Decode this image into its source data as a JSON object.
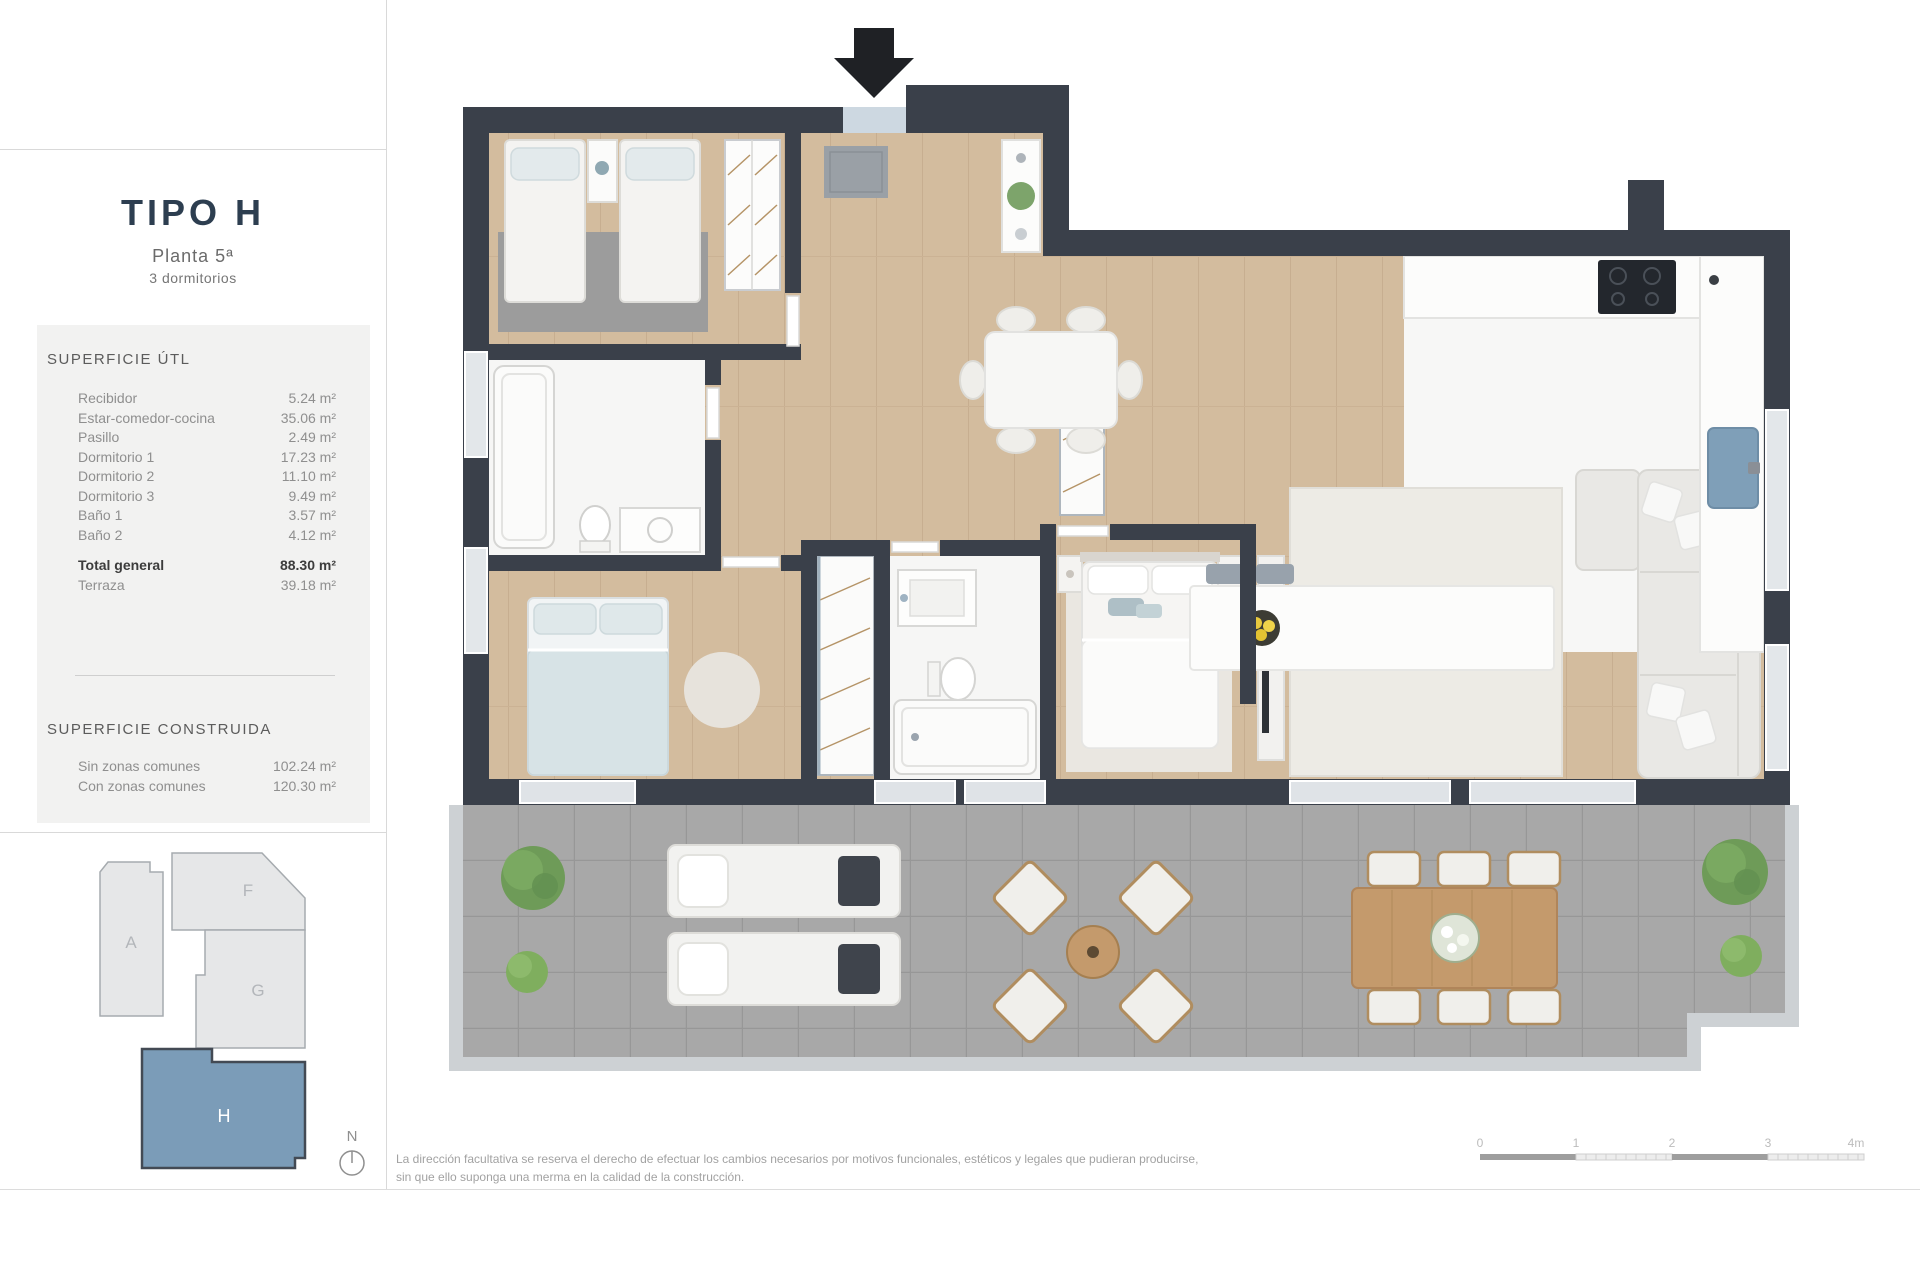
{
  "sidebar": {
    "title": "TIPO H",
    "subtitle": "Planta 5ª",
    "subtitle2": "3 dormitorios",
    "superficie_util": {
      "heading": "SUPERFICIE ÚTL",
      "rows": [
        {
          "label": "Recibidor",
          "value": "5.24 m²"
        },
        {
          "label": "Estar-comedor-cocina",
          "value": "35.06 m²"
        },
        {
          "label": "Pasillo",
          "value": "2.49 m²"
        },
        {
          "label": "Dormitorio 1",
          "value": "17.23 m²"
        },
        {
          "label": "Dormitorio 2",
          "value": "11.10 m²"
        },
        {
          "label": "Dormitorio 3",
          "value": "9.49 m²"
        },
        {
          "label": "Baño 1",
          "value": "3.57 m²"
        },
        {
          "label": "Baño 2",
          "value": "4.12 m²"
        }
      ],
      "total": {
        "label": "Total general",
        "value": "88.30 m²"
      },
      "terraza": {
        "label": "Terraza",
        "value": "39.18 m²"
      }
    },
    "superficie_construida": {
      "heading": "SUPERFICIE CONSTRUIDA",
      "rows": [
        {
          "label": "Sin zonas comunes",
          "value": "102.24 m²"
        },
        {
          "label": "Con zonas comunes",
          "value": "120.30 m²"
        }
      ]
    },
    "keyplan": {
      "units": [
        "A",
        "F",
        "G",
        "H"
      ],
      "highlighted": "H",
      "highlight_color": "#7b9cb8"
    },
    "north_label": "N"
  },
  "footer": {
    "disclaimer_line1": "La dirección facultativa se reserva el derecho de efectuar los cambios necesarios por motivos funcionales, estéticos y legales que pudieran producirse,",
    "disclaimer_line2": "sin que ello suponga una merma en la calidad de la construcción.",
    "scale": {
      "labels": [
        "0",
        "1",
        "2",
        "3",
        "4m"
      ]
    }
  },
  "colors": {
    "wall": "#3a404a",
    "wood_floor": "#d3bc9e",
    "terrace_tile": "#a8a8a8",
    "sink_blue": "#7f9fb8",
    "keyplan_highlight": "#7b9cb8",
    "title_navy": "#2d3e50"
  }
}
